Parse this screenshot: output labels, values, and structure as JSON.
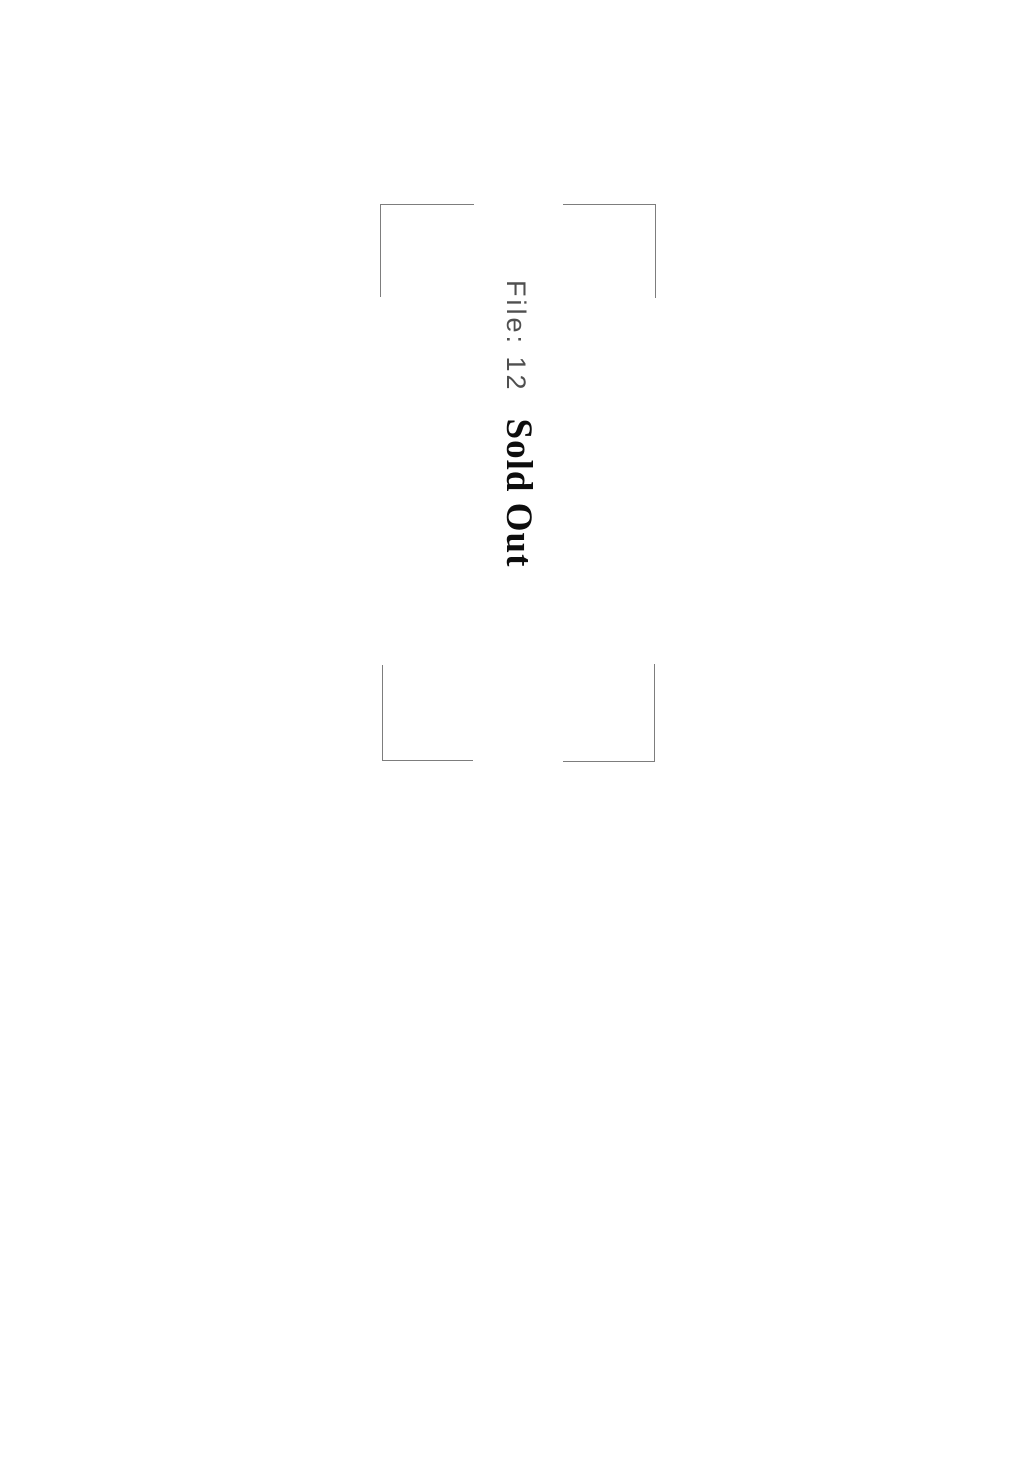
{
  "page": {
    "kind": "scanned-divider-page",
    "file_label": "File: 12",
    "status_text": "Sold Out"
  },
  "frame": {
    "description": "rectangular frame printed only at the four corners (edges interrupted)",
    "corners": [
      "top-left",
      "top-right",
      "bottom-left",
      "bottom-right"
    ]
  },
  "colors": {
    "page_background": "#ffffff",
    "frame_line": "#7d7d7d",
    "file_label_text": "#4f4f4f",
    "status_text": "#0d0d0d"
  },
  "text_orientation": "rotated-90-clockwise"
}
